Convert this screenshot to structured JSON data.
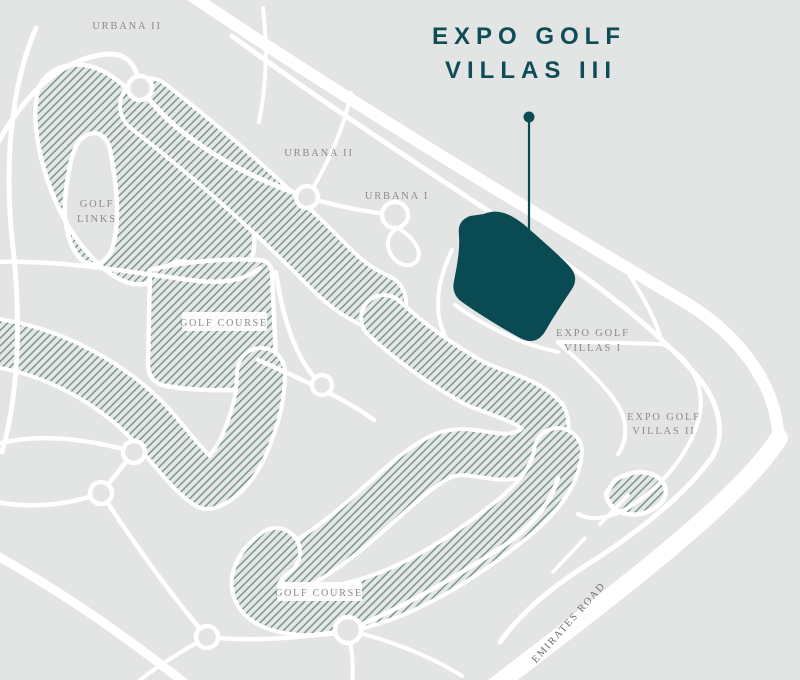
{
  "title": {
    "line1": "EXPO GOLF",
    "line2": "VILLAS III"
  },
  "labels": {
    "urbana_ii_top": "URBANA II",
    "urbana_ii": "URBANA II",
    "urbana_i": "URBANA I",
    "golf_links_line1": "GOLF",
    "golf_links_line2": "LINKS",
    "golf_course_west": "GOLF COURSE",
    "golf_course_south": "GOLF COURSE",
    "expo_golf_villas_i_line1": "EXPO GOLF",
    "expo_golf_villas_i_line2": "VILLAS I",
    "expo_golf_villas_ii_line1": "EXPO GOLF",
    "expo_golf_villas_ii_line2": "VILLAS II",
    "emirates_road": "EMIRATES ROAD"
  },
  "map": {
    "highlighted_plot": "Expo Golf Villas III site",
    "pin": "location pin pointing to highlighted plot"
  },
  "colors": {
    "background": "#e3e4e4",
    "road": "#ffffff",
    "hatch": "#6e948a",
    "hatch_bg": "#e5e6e5",
    "plot": "#0a4a53",
    "title_text": "#0e4d56",
    "label_text": "#8b8b8b",
    "emirates_text": "#6e6e6e"
  }
}
